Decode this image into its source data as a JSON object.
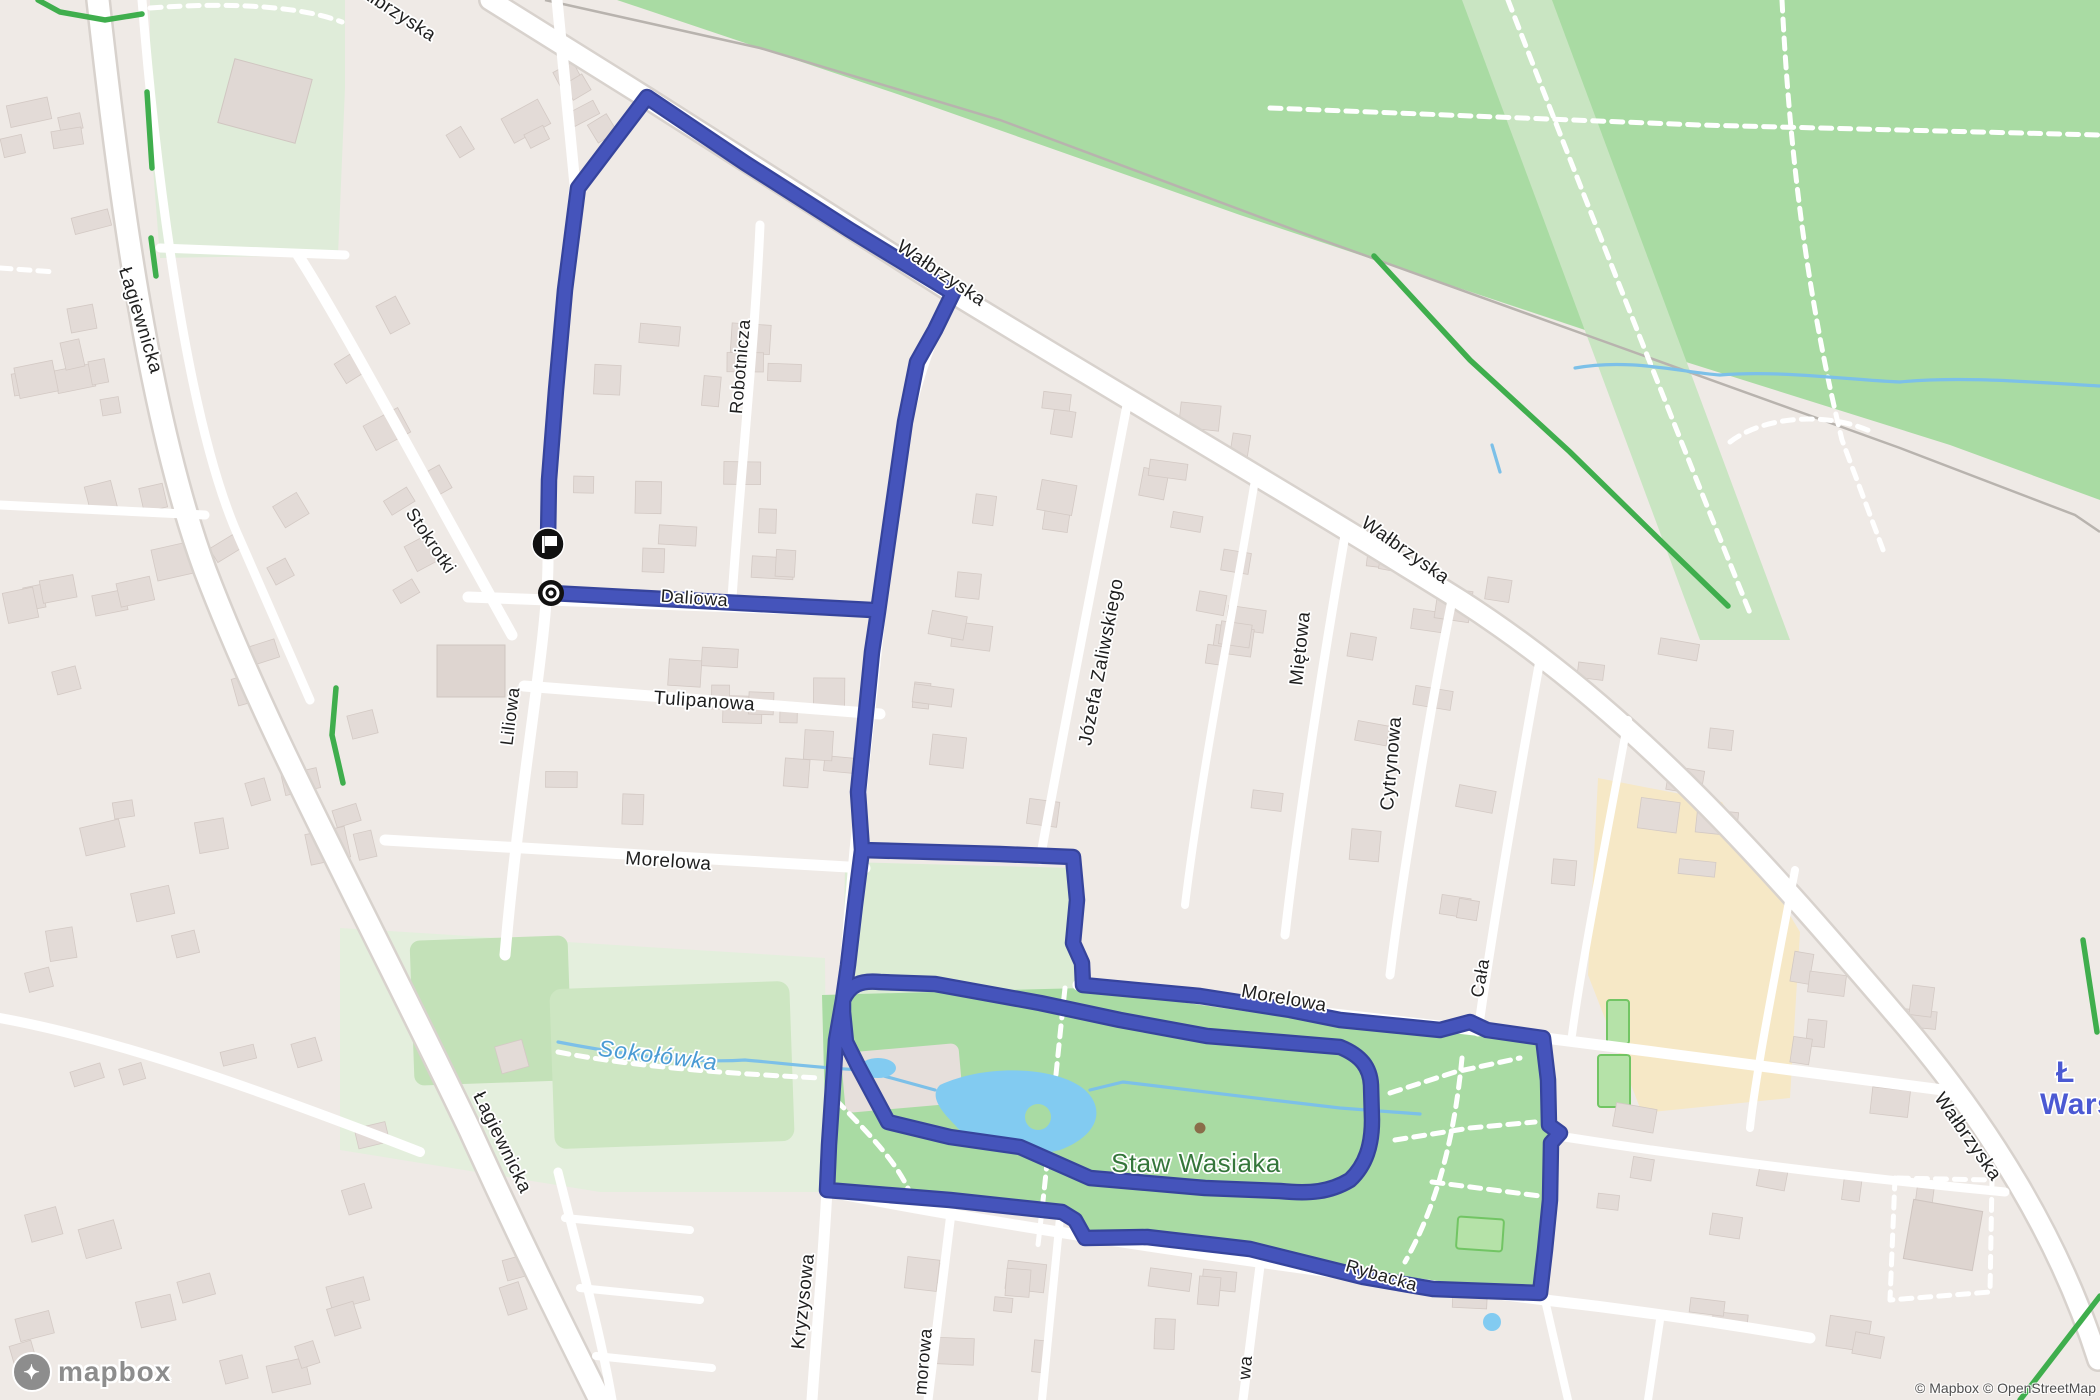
{
  "map_type": "mapbox-route-map",
  "colors": {
    "route": "#4554bb",
    "route_casing": "#36449c",
    "water": "#7cc0e8",
    "water_fill": "#82cbf1",
    "forest": "#a9dba3",
    "park_light": "#dcecd4",
    "meadow": "#e4efdd",
    "urban": "#efeae6",
    "building": "#e3dbd7",
    "orange_area": "#f6e8c6",
    "green_path": "#3fae4d",
    "label_dark": "#1f1f1f",
    "water_label": "#4a9bd4",
    "park_label": "#35763b",
    "place_label": "#4b59d3",
    "railway": "#b8b3ae"
  },
  "labels": [
    {
      "text": "Łagiewnicka"
    },
    {
      "text": "Łagiewnicka"
    },
    {
      "text": "Wałbrzyska"
    },
    {
      "text": "Wałbrzyska"
    },
    {
      "text": "Wałbrzyska"
    },
    {
      "text": "Wałbrzyska"
    },
    {
      "text": "Stokrotki"
    },
    {
      "text": "Liliowa"
    },
    {
      "text": "Daliowa"
    },
    {
      "text": "Tulipanowa"
    },
    {
      "text": "Morelowa"
    },
    {
      "text": "Morelowa"
    },
    {
      "text": "Robotnicza"
    },
    {
      "text": "Józefa Zaliwskiego"
    },
    {
      "text": "Miętowa"
    },
    {
      "text": "Cytrynowa"
    },
    {
      "text": "Cała"
    },
    {
      "text": "Kryzysowa"
    },
    {
      "text": "Rybacka"
    },
    {
      "text": "morowa"
    },
    {
      "text": "wa"
    },
    {
      "text": "Sokołówka"
    },
    {
      "text": "Staw Wasiaka"
    }
  ],
  "place_label": {
    "line1": "Ł",
    "line2": "Wars"
  },
  "markers": {
    "finish_icon": "finish-flag-icon",
    "start_icon": "start-dot-icon"
  },
  "logo": {
    "text": "mapbox"
  },
  "attribution": {
    "text": "© Mapbox © OpenStreetMap"
  }
}
